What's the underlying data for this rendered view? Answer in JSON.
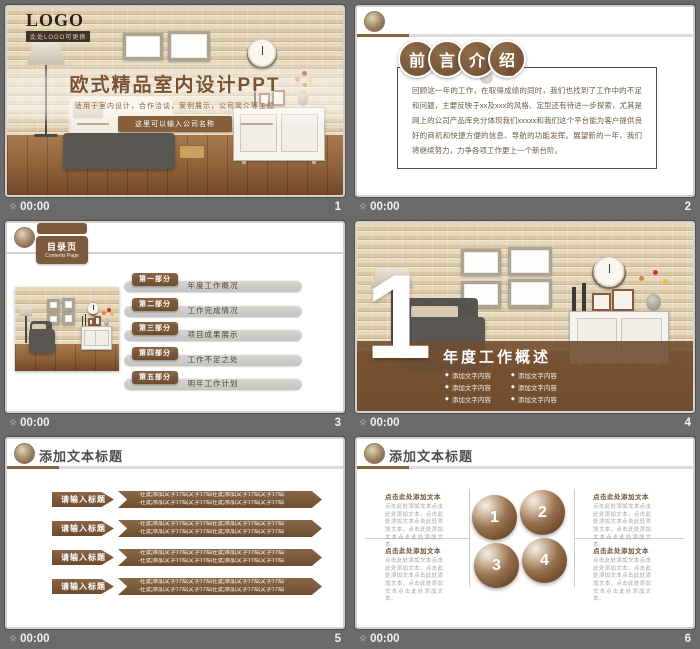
{
  "page": {
    "background_color": "#6a6a6a",
    "accent_brown": "#7b5a3c",
    "progress_gray": "#dcdcdc"
  },
  "footer": {
    "star_icon": "☆",
    "time": "00:00"
  },
  "slides": {
    "s1": {
      "number": "1",
      "logo": "LOGO",
      "logo_sub": "此处LOGO可更换",
      "title": "欧式精品室内设计PPT",
      "subtitle": "适用于室内设计，合作洽谈，案例展示，公司简介等主题",
      "button": "这里可以输入公司名称"
    },
    "s2": {
      "number": "2",
      "title_chars": [
        "前",
        "言",
        "介",
        "绍"
      ],
      "body": "回顾这一年的工作，在取得成绩的同时，我们也找到了工作中的不足和问题，主要反映于xx及xxx的风格、定型还有待进一步探索，尤其是网上的公司产品库充分体现我们xxxxx和我们这个平台能为客户提供良好的商机和快捷方便的信息、导航的功能发挥。展望新的一年，我们将继续努力，力争各项工作更上一个新台阶。"
    },
    "s3": {
      "number": "3",
      "tab_title": "目录页",
      "tab_subtitle": "Contents Page",
      "items": [
        {
          "label": "第一部分",
          "text": "年度工作概况"
        },
        {
          "label": "第二部分",
          "text": "工作完成情况"
        },
        {
          "label": "第三部分",
          "text": "项目成果展示"
        },
        {
          "label": "第四部分",
          "text": "工作不足之处"
        },
        {
          "label": "第五部分",
          "text": "明年工作计划"
        }
      ]
    },
    "s4": {
      "number": "4",
      "big_number": "1",
      "title": "年度工作概述",
      "bullet_icon": "◆",
      "bullets": [
        "添加文字内容",
        "添加文字内容",
        "添加文字内容",
        "添加文字内容",
        "添加文字内容",
        "添加文字内容"
      ]
    },
    "s5": {
      "number": "5",
      "header_title": "添加文本标题",
      "rows": [
        {
          "label": "请输入标题",
          "line1": "·在此添加文字介绍文字介绍在此添加文字介绍文字介绍",
          "line2": "·在此添加文字介绍文字介绍在此添加文字介绍文字介绍"
        },
        {
          "label": "请输入标题",
          "line1": "·在此添加文字介绍文字介绍在此添加文字介绍文字介绍",
          "line2": "·在此添加文字介绍文字介绍在此添加文字介绍文字介绍"
        },
        {
          "label": "请输入标题",
          "line1": "·在此添加文字介绍文字介绍在此添加文字介绍文字介绍",
          "line2": "·在此添加文字介绍文字介绍在此添加文字介绍文字介绍"
        },
        {
          "label": "请输入标题",
          "line1": "·在此添加文字介绍文字介绍在此添加文字介绍文字介绍",
          "line2": "·在此添加文字介绍文字介绍在此添加文字介绍文字介绍"
        }
      ]
    },
    "s6": {
      "number": "6",
      "header_title": "添加文本标题",
      "numbers": [
        "1",
        "2",
        "3",
        "4"
      ],
      "blocks": [
        {
          "heading": "点击此处添加文本",
          "body": "点击此处添加文本点击此处添加文本，点击此处添加文本点击此处添加文本，点击此处添加文本点击此处添加文本。"
        },
        {
          "heading": "点击此处添加文本",
          "body": "点击此处添加文本点击此处添加文本，点击此处添加文本点击此处添加文本，点击此处添加文本点击此处添加文本。"
        },
        {
          "heading": "点击此处添加文本",
          "body": "点击此处添加文本点击此处添加文本，点击此处添加文本点击此处添加文本，点击此处添加文本点击此处添加文本。"
        },
        {
          "heading": "点击此处添加文本",
          "body": "点击此处添加文本点击此处添加文本，点击此处添加文本点击此处添加文本，点击此处添加文本点击此处添加文本。"
        }
      ]
    }
  }
}
